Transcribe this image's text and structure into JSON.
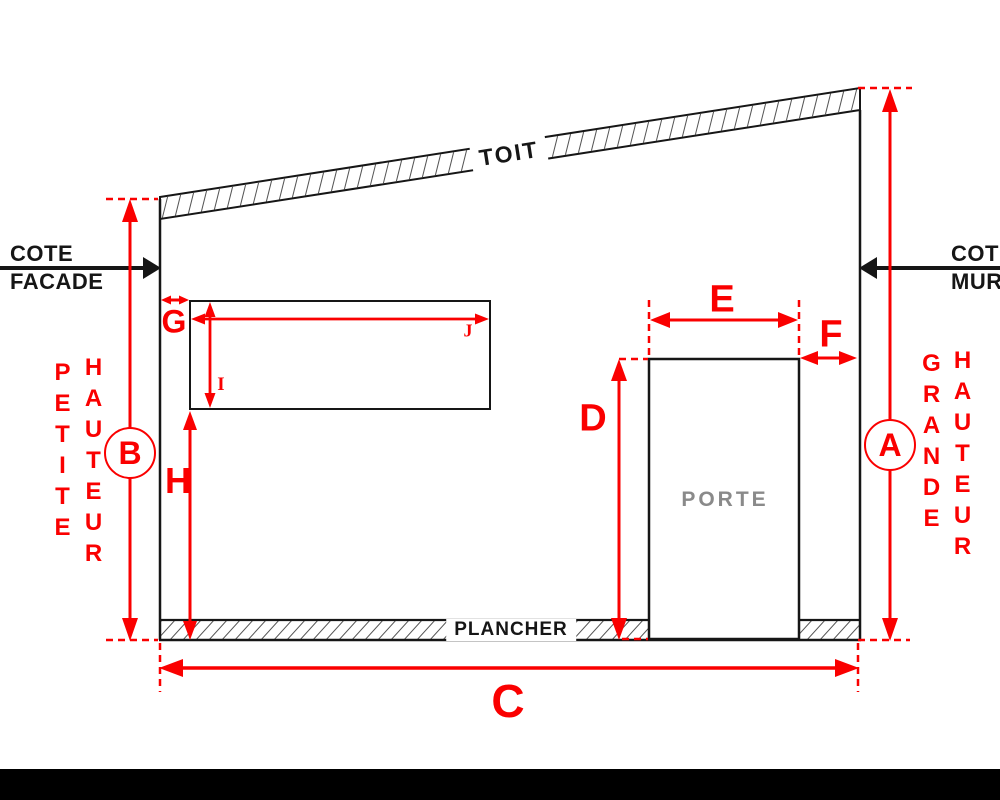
{
  "colors": {
    "dimension_red": "#fa0000",
    "structure_black": "#161616",
    "door_text_gray": "#8a8a8a",
    "hatch_gray": "#555555"
  },
  "structure": {
    "roof_label": "TOIT",
    "floor_label": "PLANCHER",
    "door_label": "PORTE"
  },
  "references": {
    "facade": {
      "line1": "COTE",
      "line2": "FACADE"
    },
    "mur": {
      "line1": "COTE",
      "line2": "MUR"
    }
  },
  "height_annotations": {
    "left": {
      "word1": "PETITE",
      "word2": "HAUTEUR",
      "badge": "B"
    },
    "right": {
      "word1": "GRANDE",
      "word2": "HAUTEUR",
      "badge": "A"
    }
  },
  "dims": {
    "A": "A",
    "B": "B",
    "C": "C",
    "D": "D",
    "E": "E",
    "F": "F",
    "G": "G",
    "H": "H",
    "I": "I",
    "J": "J"
  }
}
